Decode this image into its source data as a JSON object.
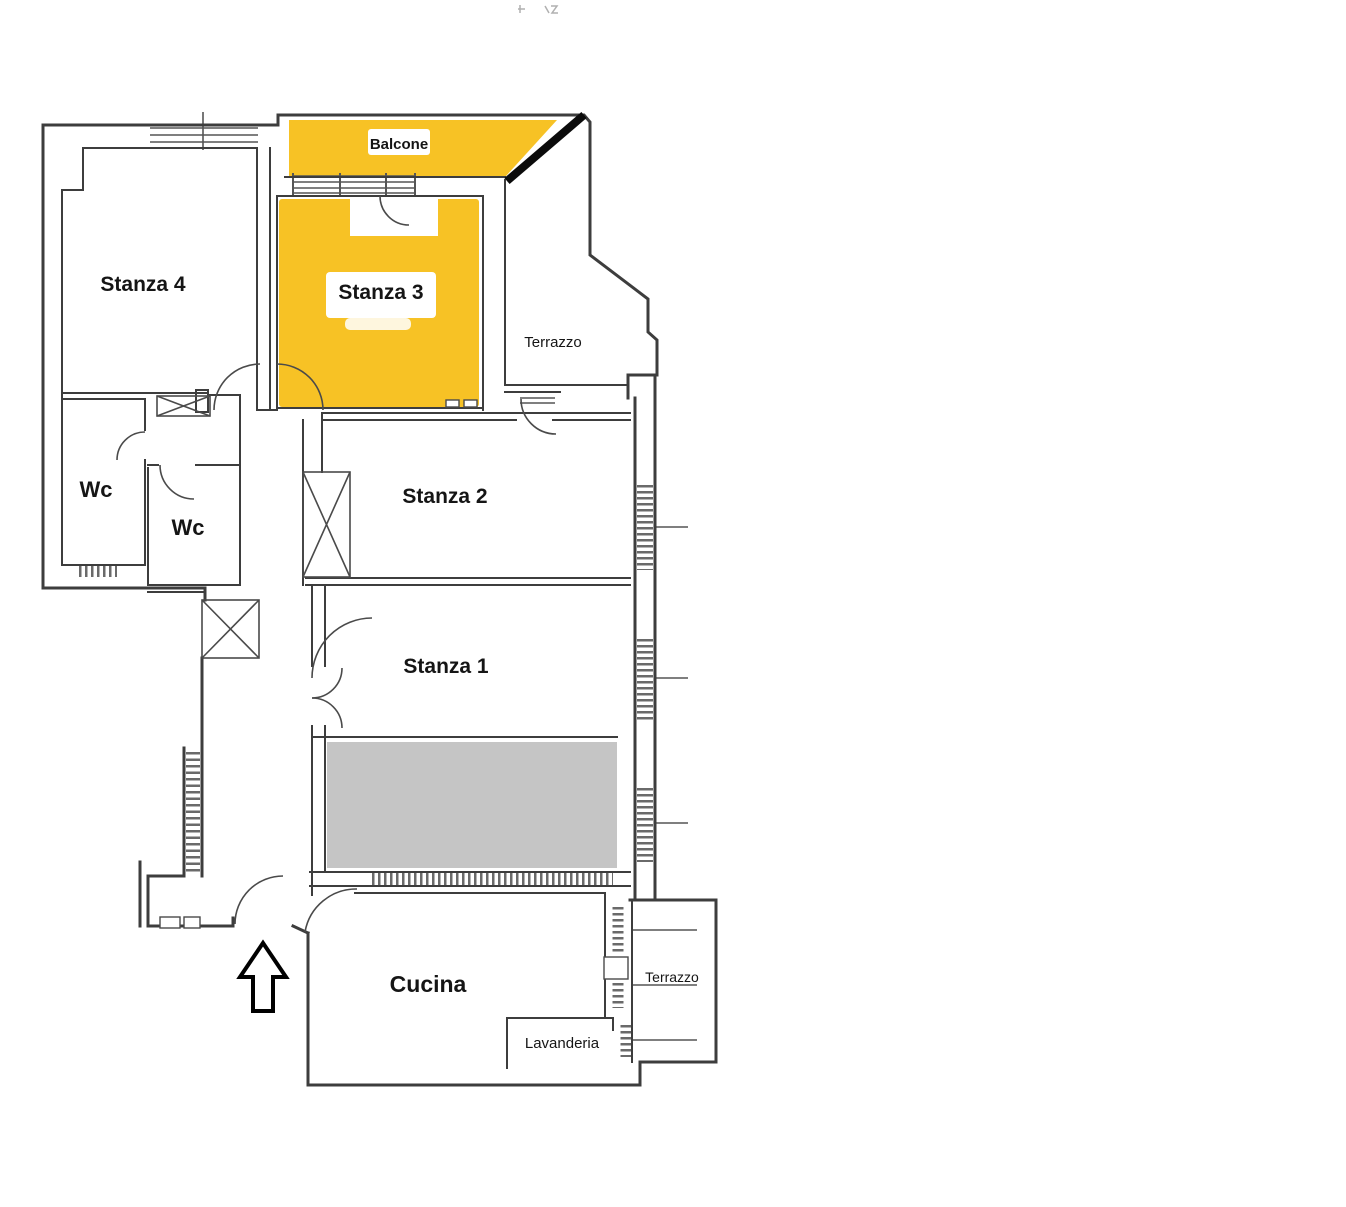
{
  "plan": {
    "rooms": {
      "stanza4": {
        "label": "Stanza 4"
      },
      "stanza3": {
        "label": "Stanza 3",
        "highlighted": true
      },
      "balcone": {
        "label": "Balcone",
        "highlighted": true
      },
      "terrazzo_top": {
        "label": "Terrazzo"
      },
      "wc_left": {
        "label": "Wc"
      },
      "wc_inner": {
        "label": "Wc"
      },
      "stanza2": {
        "label": "Stanza 2"
      },
      "stanza1": {
        "label": "Stanza 1"
      },
      "cucina": {
        "label": "Cucina"
      },
      "lavanderia": {
        "label": "Lavanderia"
      },
      "terrazzo_bottom": {
        "label": "Terrazzo"
      }
    },
    "colors": {
      "highlight": "#F7C225",
      "covered_area": "#C5C5C5",
      "wall_line": "#3D3D3D",
      "paper": "#FFFFFF"
    },
    "entrance": {
      "icon": "up-arrow"
    }
  }
}
